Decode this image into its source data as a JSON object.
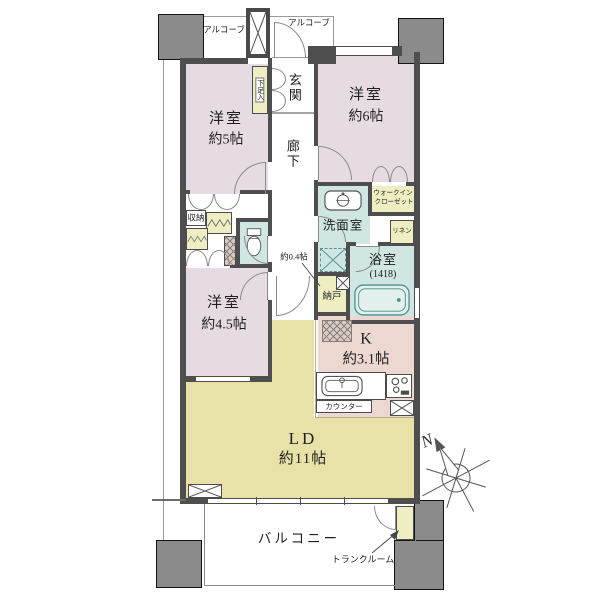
{
  "labels": {
    "alcove_left": "アルコーブ",
    "alcove_right": "アルコーブ",
    "entrance": "玄関",
    "shoe_cabinet": "下足入",
    "hallway": "廊下",
    "room5_name": "洋室",
    "room5_size": "約5帖",
    "room6_name": "洋室",
    "room6_size": "約6帖",
    "room45_name": "洋室",
    "room45_size": "約4.5帖",
    "closet": "収納",
    "wic_line1": "ウォークイン",
    "wic_line2": "クローゼット",
    "linen": "リネン",
    "washroom": "洗面室",
    "bath_name": "浴室",
    "bath_size": "(1418)",
    "storeroom": "納戸",
    "storeroom_size": "約0.4帖",
    "kitchen_name": "K",
    "kitchen_size": "約3.1帖",
    "counter": "カウンター",
    "living_name": "LD",
    "living_size": "約11帖",
    "balcony": "バルコニー",
    "trunk_room": "トランクルーム",
    "compass_north": "N"
  },
  "colors": {
    "wall": "#4e4e4e",
    "pillar": "#8b8b8b",
    "bedroom": "#e6dbe3",
    "living": "#e8e2a8",
    "kitchen": "#ecd8d0",
    "wet_area": "#cfe6e2",
    "closet": "#eeeec2",
    "tub": "#e2f1ee"
  }
}
